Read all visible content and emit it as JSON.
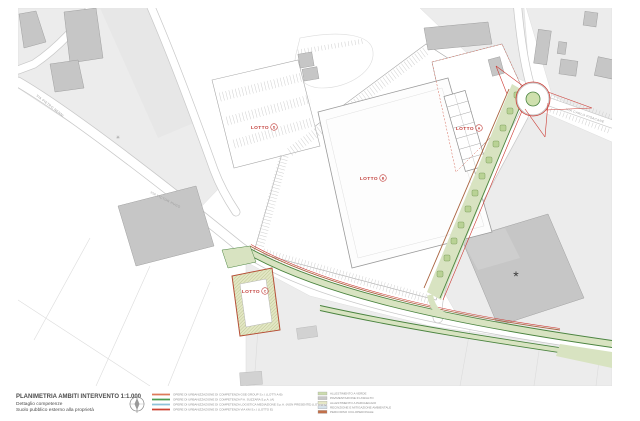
{
  "title_block": {
    "line1": "PLANIMETRIA AMBITI INTERVENTO 1:1.000",
    "line2": "Dettaglio competenze",
    "line3": "Suolo pubblico esterno alla proprietà"
  },
  "legend": {
    "line_items": [
      {
        "color": "#dd7a5a",
        "label": "OPERE DI URBANIZZAZIONE DI COMPETENZA GSE GROUP S.r.l. (LOTTI A-B)"
      },
      {
        "color": "#4d9c52",
        "label": "OPERE DI URBANIZZAZIONE DI COMPETENZA P.A. SUZZARA S.p.A. (A)"
      },
      {
        "color": "#8fc2d9",
        "label": "OPERE DI URBANIZZAZIONE DI COMPETENZA LOGISTICA MEDIAZIONE S.p.A. (NON PRESENTE) (LOTTO C)"
      },
      {
        "color": "#cc4333",
        "label": "OPERE DI URBANIZZAZIONE DI COMPETENZA VIA KM S.r.l. (LOTTO E)"
      }
    ],
    "area_items": [
      {
        "color": "#ccdcae",
        "label": "ALLESTIMENTO A VERDE"
      },
      {
        "color": "#c8c8c8",
        "label": "PAVIMENTAZIONE IN ASFALTO"
      },
      {
        "color": "#e6e8c6",
        "label": "ALLESTIMENTO A PARCHEGGIO"
      },
      {
        "color": "#d6e2ea",
        "label": "RECINZIONE E MITIGAZIONE AMBIENTALE"
      },
      {
        "color": "#c2704a",
        "label": "PERCORSO CICLOPEDONALE"
      }
    ]
  },
  "plan": {
    "lots": [
      {
        "name": "LOTTO",
        "letter": "A"
      },
      {
        "name": "LOTTO",
        "letter": "B"
      },
      {
        "name": "LOTTO",
        "letter": "C"
      },
      {
        "name": "LOTTO",
        "letter": "D"
      }
    ],
    "roads": [
      {
        "label": "VIA PIETRO NENNI"
      },
      {
        "label": "VIA VICTOR HUGO"
      },
      {
        "label": "VIA CARLO PISACANE"
      }
    ],
    "building_marker": "*",
    "colors": {
      "works_red": "#cc3a33",
      "works_sienna": "#a9633f",
      "green_edge": "#4b8440",
      "green_fill": "#d8e3c1",
      "lot_label_red": "#c2403c"
    }
  }
}
